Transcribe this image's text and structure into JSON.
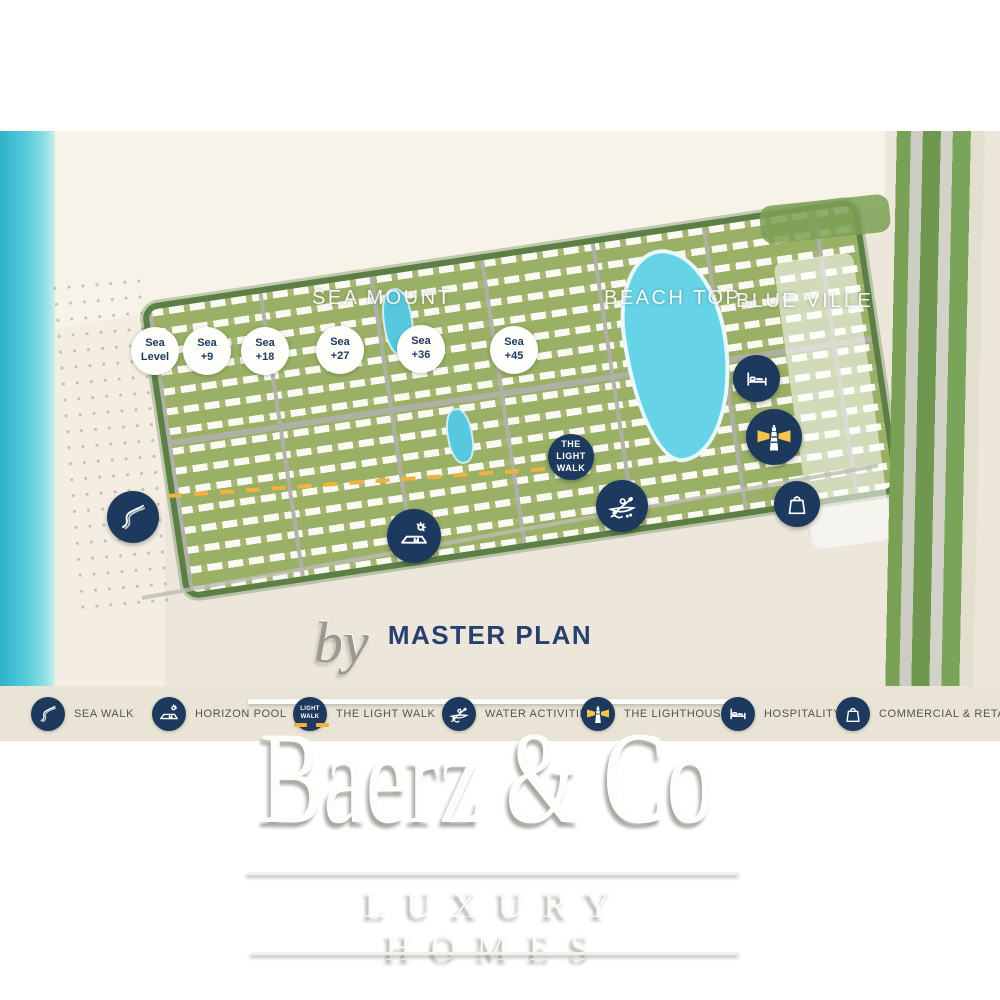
{
  "map": {
    "title": "MASTER PLAN",
    "zones": [
      {
        "name": "SEA MOUNT"
      },
      {
        "name": "BEACH TOP"
      },
      {
        "name": "BLUE VILLE"
      }
    ],
    "elevation_badges": [
      {
        "line1": "Sea",
        "line2": "Level"
      },
      {
        "line1": "Sea",
        "line2": "+9"
      },
      {
        "line1": "Sea",
        "line2": "+18"
      },
      {
        "line1": "Sea",
        "line2": "+27"
      },
      {
        "line1": "Sea",
        "line2": "+36"
      },
      {
        "line1": "Sea",
        "line2": "+45"
      }
    ],
    "light_walk_badge": {
      "line1": "THE",
      "line2": "LIGHT",
      "line3": "WALK"
    }
  },
  "legend": {
    "items": [
      {
        "label": "SEA WALK",
        "icon": "sea-walk-icon"
      },
      {
        "label": "HORIZON POOL",
        "icon": "horizon-pool-icon"
      },
      {
        "label": "THE LIGHT WALK",
        "icon": "light-walk-icon"
      },
      {
        "label": "WATER ACTIVITIES",
        "icon": "water-activities-icon"
      },
      {
        "label": "THE LIGHTHOUSE",
        "icon": "lighthouse-icon"
      },
      {
        "label": "HOSPITALITY",
        "icon": "hospitality-icon"
      },
      {
        "label": "COMMERCIAL & RETAIL",
        "icon": "commercial-retail-icon"
      }
    ],
    "light_walk_mini": {
      "line1": "LIGHT",
      "line2": "WALK"
    }
  },
  "watermark": {
    "by": "by",
    "brand": "Baerz & Co",
    "tagline": "LUXURY HOMES"
  },
  "colors": {
    "navy": "#1d3a5e",
    "accent_yellow": "#f2b23e",
    "ocean": "#45c0d4",
    "lagoon": "#66d4e6",
    "map_background": "#ece7da",
    "legend_background": "#e9e4d6",
    "title_navy": "#27406f"
  }
}
